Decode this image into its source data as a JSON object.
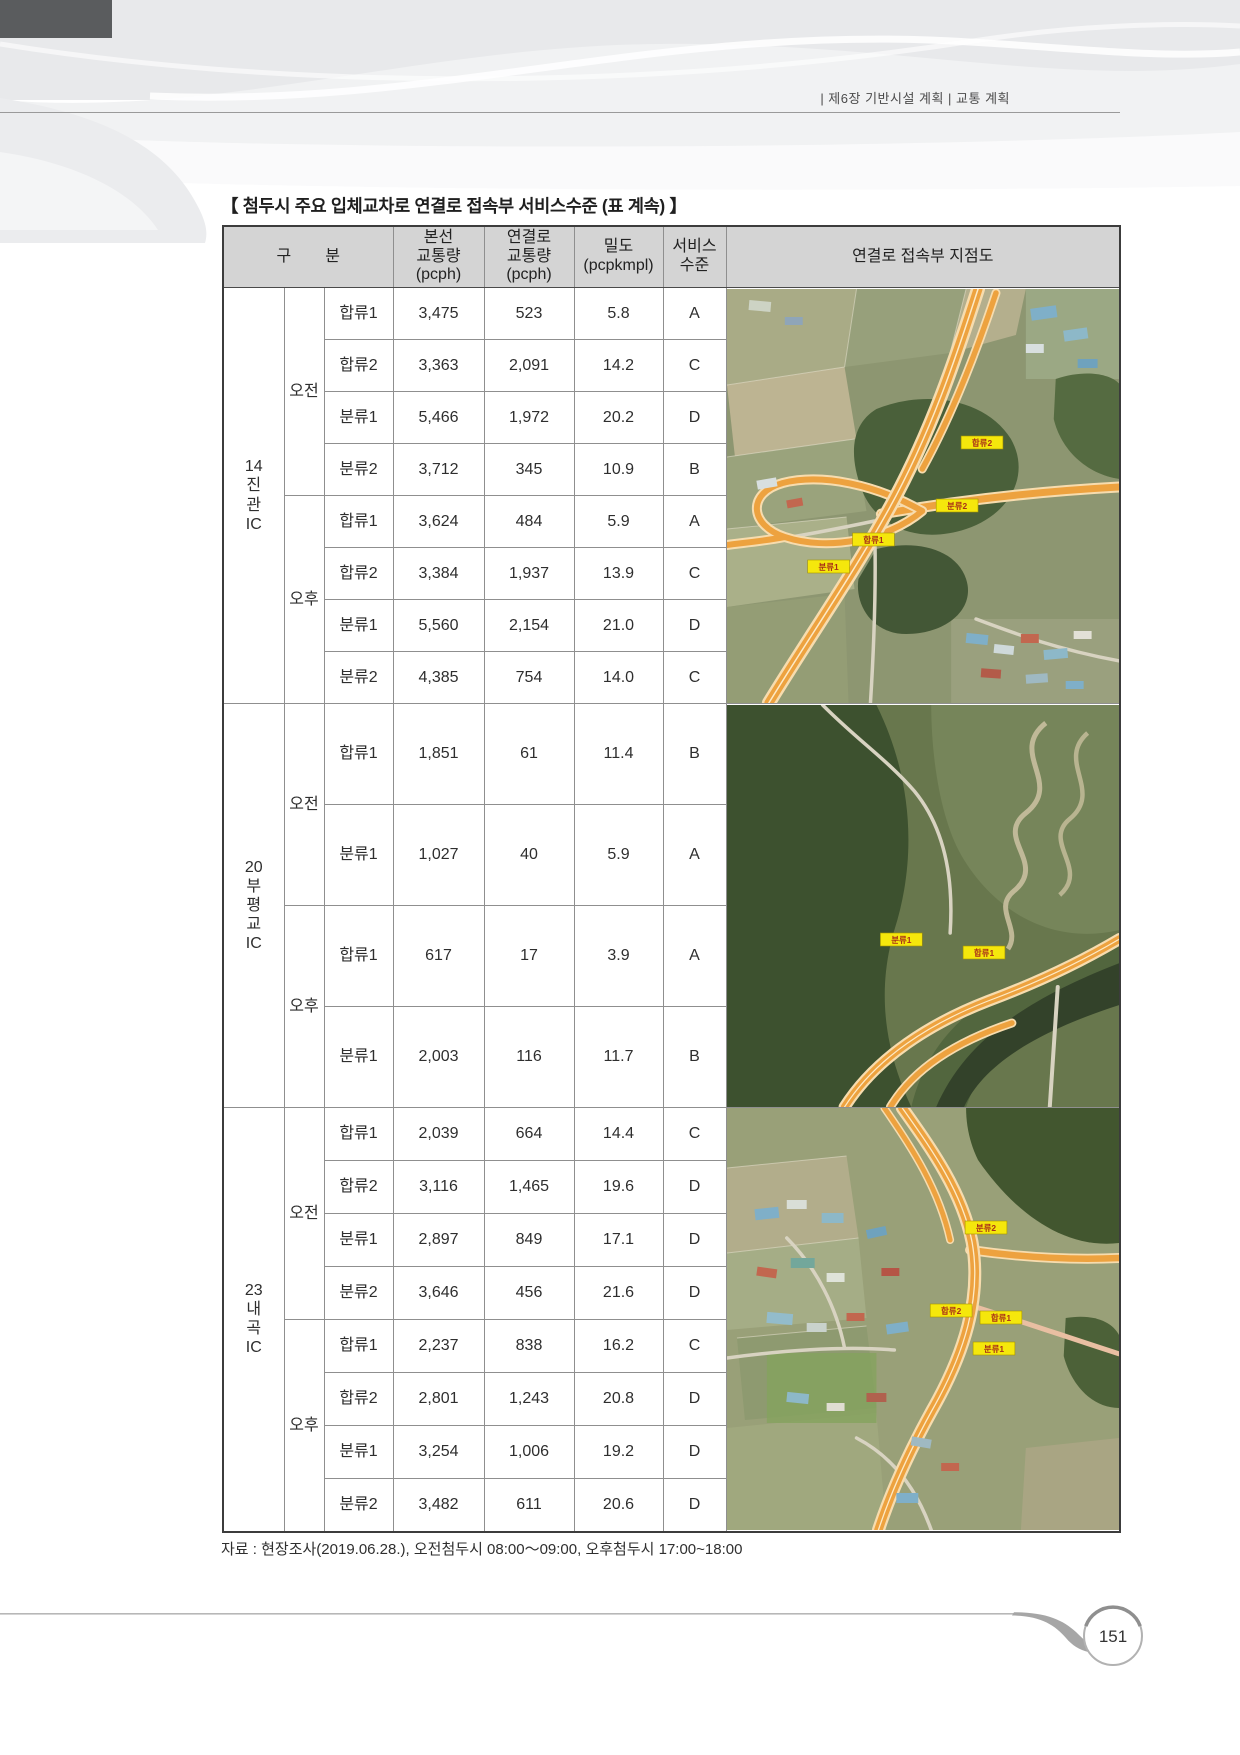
{
  "page": {
    "header_right": "|  제6장 기반시설 계획  | 교통 계획",
    "page_number": "151"
  },
  "table": {
    "title": "【 첨두시 주요 입체교차로 연결로 접속부 서비스수준 (표 계속) 】",
    "header": {
      "gubun": [
        "구",
        "분"
      ],
      "mainline": "본선\n교통량\n(pcph)",
      "ramp": "연결로\n교통량\n(pcph)",
      "density": "밀도\n(pcpkmpl)",
      "los": "서비스\n수준",
      "map": "연결로 접속부 지점도"
    },
    "sections": [
      {
        "ic_label": "14\n진\n관\nIC",
        "map_labels": [
          "합류2",
          "분류2",
          "합류1",
          "분류1"
        ],
        "groups": [
          {
            "period": "오전",
            "rows": [
              {
                "ramp": "합류1",
                "mainline": "3,475",
                "ramp_volume": "523",
                "density": "5.8",
                "los": "A"
              },
              {
                "ramp": "합류2",
                "mainline": "3,363",
                "ramp_volume": "2,091",
                "density": "14.2",
                "los": "C"
              },
              {
                "ramp": "분류1",
                "mainline": "5,466",
                "ramp_volume": "1,972",
                "density": "20.2",
                "los": "D"
              },
              {
                "ramp": "분류2",
                "mainline": "3,712",
                "ramp_volume": "345",
                "density": "10.9",
                "los": "B"
              }
            ]
          },
          {
            "period": "오후",
            "rows": [
              {
                "ramp": "합류1",
                "mainline": "3,624",
                "ramp_volume": "484",
                "density": "5.9",
                "los": "A"
              },
              {
                "ramp": "합류2",
                "mainline": "3,384",
                "ramp_volume": "1,937",
                "density": "13.9",
                "los": "C"
              },
              {
                "ramp": "분류1",
                "mainline": "5,560",
                "ramp_volume": "2,154",
                "density": "21.0",
                "los": "D"
              },
              {
                "ramp": "분류2",
                "mainline": "4,385",
                "ramp_volume": "754",
                "density": "14.0",
                "los": "C"
              }
            ]
          }
        ]
      },
      {
        "ic_label": "20\n부\n평\n교\nIC",
        "map_labels": [
          "분류1",
          "합류1"
        ],
        "groups": [
          {
            "period": "오전",
            "rows": [
              {
                "ramp": "합류1",
                "mainline": "1,851",
                "ramp_volume": "61",
                "density": "11.4",
                "los": "B"
              },
              {
                "ramp": "분류1",
                "mainline": "1,027",
                "ramp_volume": "40",
                "density": "5.9",
                "los": "A"
              }
            ]
          },
          {
            "period": "오후",
            "rows": [
              {
                "ramp": "합류1",
                "mainline": "617",
                "ramp_volume": "17",
                "density": "3.9",
                "los": "A"
              },
              {
                "ramp": "분류1",
                "mainline": "2,003",
                "ramp_volume": "116",
                "density": "11.7",
                "los": "B"
              }
            ]
          }
        ]
      },
      {
        "ic_label": "23\n내\n곡\nIC",
        "map_labels": [
          "분류2",
          "합류2",
          "합류1",
          "분류1"
        ],
        "groups": [
          {
            "period": "오전",
            "rows": [
              {
                "ramp": "합류1",
                "mainline": "2,039",
                "ramp_volume": "664",
                "density": "14.4",
                "los": "C"
              },
              {
                "ramp": "합류2",
                "mainline": "3,116",
                "ramp_volume": "1,465",
                "density": "19.6",
                "los": "D"
              },
              {
                "ramp": "분류1",
                "mainline": "2,897",
                "ramp_volume": "849",
                "density": "17.1",
                "los": "D"
              },
              {
                "ramp": "분류2",
                "mainline": "3,646",
                "ramp_volume": "456",
                "density": "21.6",
                "los": "D"
              }
            ]
          },
          {
            "period": "오후",
            "rows": [
              {
                "ramp": "합류1",
                "mainline": "2,237",
                "ramp_volume": "838",
                "density": "16.2",
                "los": "C"
              },
              {
                "ramp": "합류2",
                "mainline": "2,801",
                "ramp_volume": "1,243",
                "density": "20.8",
                "los": "D"
              },
              {
                "ramp": "분류1",
                "mainline": "3,254",
                "ramp_volume": "1,006",
                "density": "19.2",
                "los": "D"
              },
              {
                "ramp": "분류2",
                "mainline": "3,482",
                "ramp_volume": "611",
                "density": "20.6",
                "los": "D"
              }
            ]
          }
        ]
      }
    ],
    "footnote": "자료 : 현장조사(2019.06.28.), 오전첨두시 08:00〜09:00, 오후첨두시 17:00~18:00"
  }
}
